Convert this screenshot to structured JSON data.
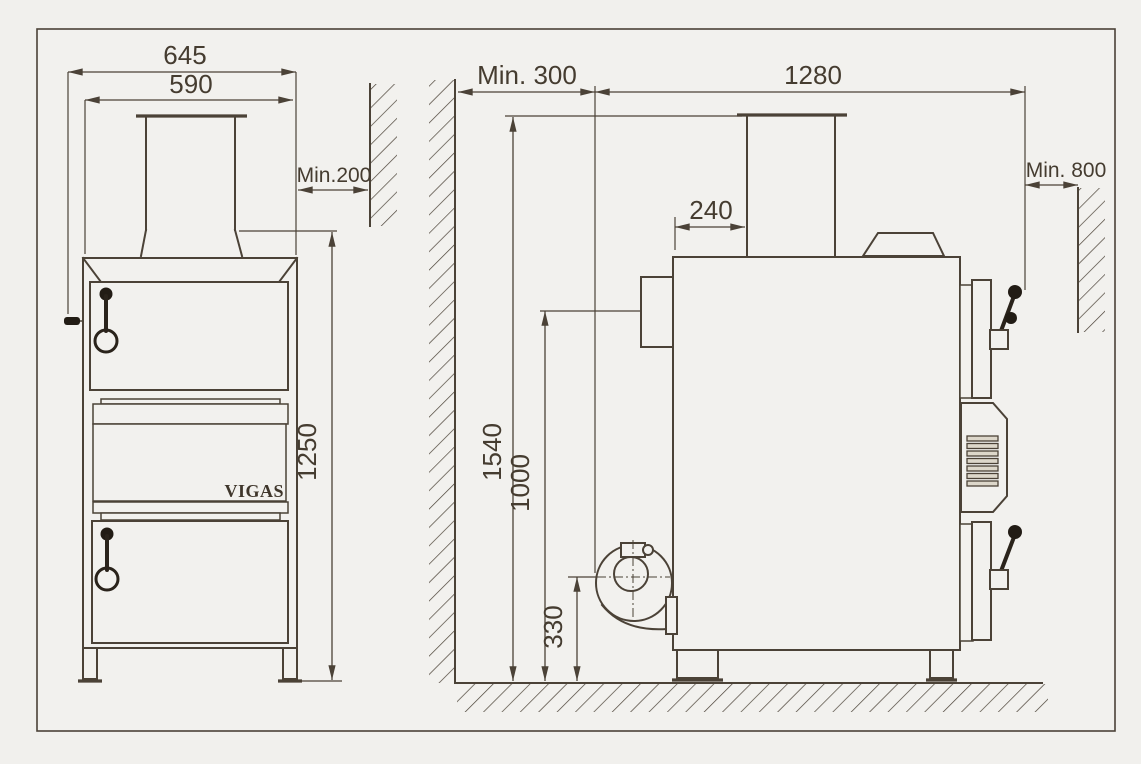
{
  "drawing": {
    "brand": "VIGAS",
    "type": "boiler installation dimensions diagram",
    "colors": {
      "line": "#4b4237",
      "background": "#f2f1ee",
      "handle": "#221c15"
    },
    "views": {
      "front": {
        "name": "front view",
        "dimensions": {
          "overall_width": "645",
          "body_width": "590",
          "side_wall_clearance": "Min.200",
          "body_height": "1250"
        }
      },
      "side": {
        "name": "side view",
        "dimensions": {
          "front_wall_clearance": "Min. 300",
          "overall_depth": "1280",
          "rear_wall_clearance": "Min. 800",
          "chimney_setback": "240",
          "chimney_top_height": "1540",
          "flue_outlet_height": "1000",
          "fan_axis_height": "330"
        }
      }
    }
  }
}
